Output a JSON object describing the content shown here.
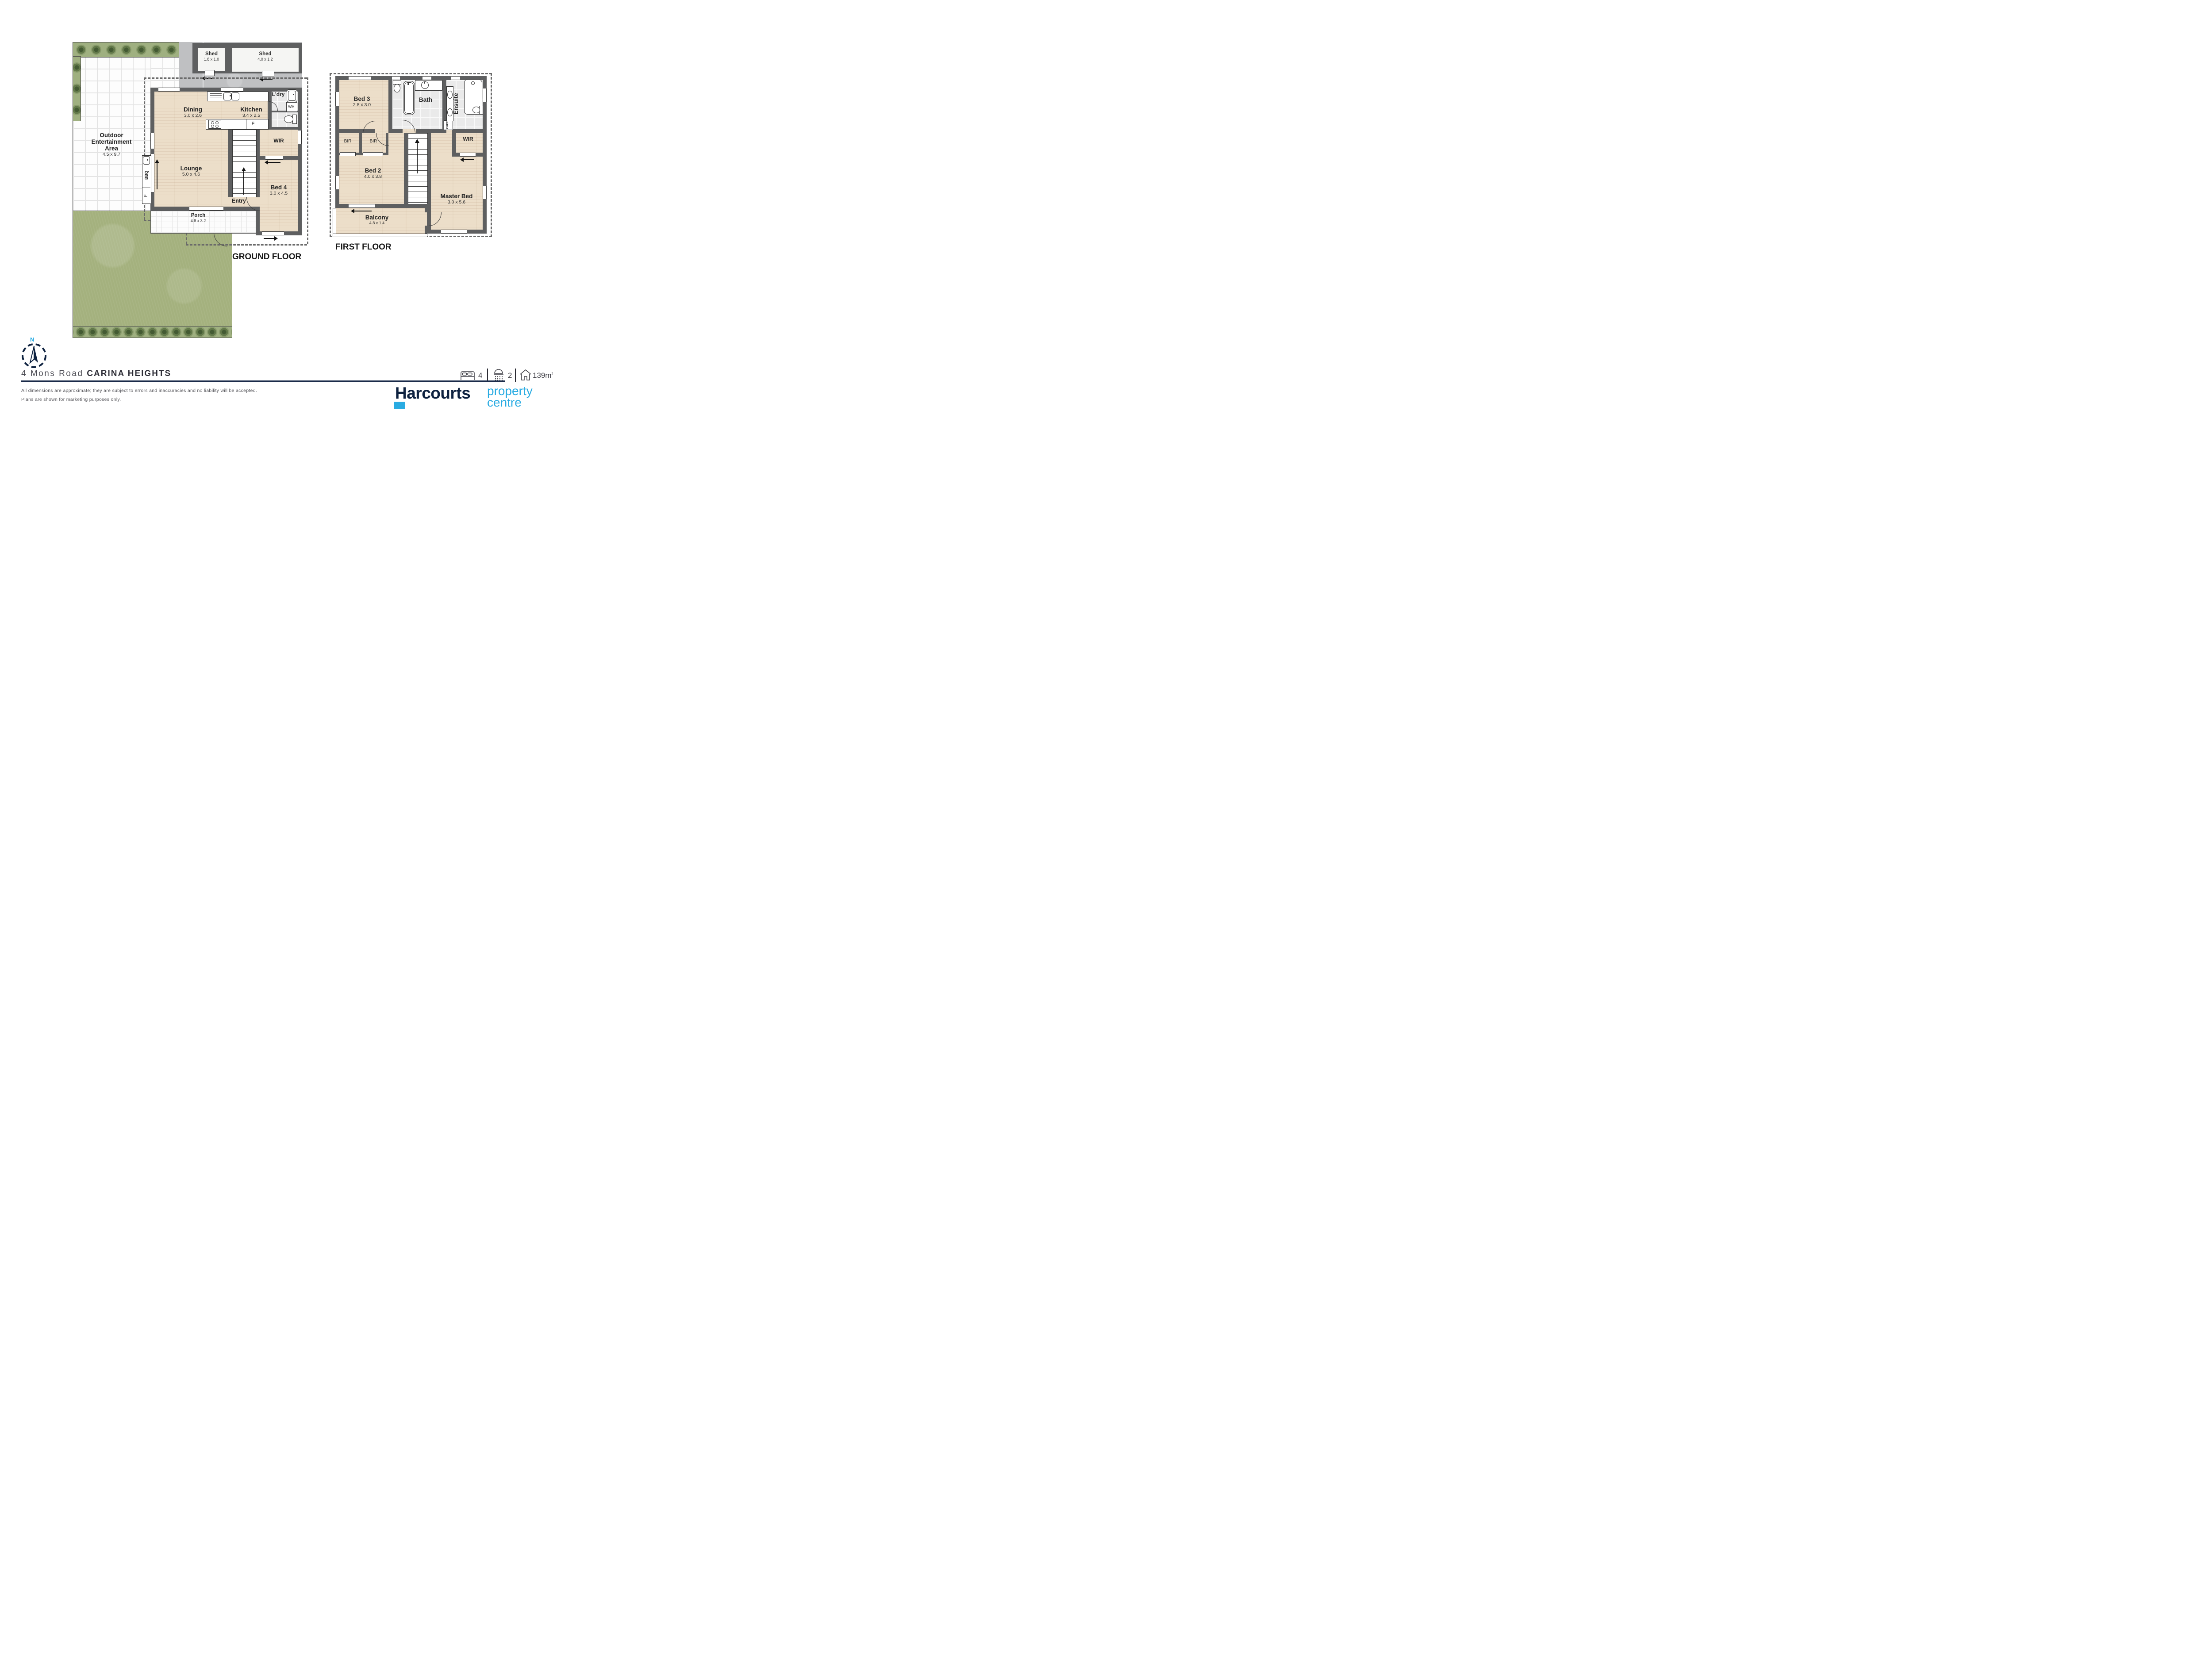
{
  "ground": {
    "title": "GROUND FLOOR",
    "outdoor": {
      "name_lines": [
        "Outdoor",
        "Entertainment",
        "Area"
      ],
      "dims": "4.5 x 9.7"
    },
    "shed_small": {
      "name": "Shed",
      "dims": "1.8 x 1.0"
    },
    "shed_large": {
      "name": "Shed",
      "dims": "4.0 x 1.2"
    },
    "dining": {
      "name": "Dining",
      "dims": "3.0 x 2.6"
    },
    "kitchen": {
      "name": "Kitchen",
      "dims": "3.4 x 2.5"
    },
    "laundry": {
      "name": "L'dry"
    },
    "washing_machine": {
      "name": "WM"
    },
    "wir": {
      "name": "WIR"
    },
    "lounge": {
      "name": "Lounge",
      "dims": "5.0 x 4.6"
    },
    "entry": {
      "name": "Entry"
    },
    "bed4": {
      "name": "Bed 4",
      "dims": "3.0 x 4.5"
    },
    "porch": {
      "name": "Porch",
      "dims": "4.8 x 3.2"
    },
    "bbq": {
      "name": "BBQ"
    },
    "bench_f": {
      "name": "F"
    },
    "kitchen_f": {
      "name": "F"
    }
  },
  "first": {
    "title": "FIRST FLOOR",
    "bed3": {
      "name": "Bed 3",
      "dims": "2.8 x 3.0"
    },
    "bath": {
      "name": "Bath"
    },
    "ensuite": {
      "name": "Ensuite"
    },
    "cupboard": {
      "name": "CUP'D"
    },
    "wir": {
      "name": "WIR"
    },
    "bir_left": {
      "name": "BIR"
    },
    "bir_right": {
      "name": "BIR"
    },
    "bed2": {
      "name": "Bed 2",
      "dims": "4.0 x 3.8"
    },
    "master": {
      "name": "Master Bed",
      "dims": "3.0 x 5.6"
    },
    "balcony": {
      "name": "Balcony",
      "dims": "4.8 x 1.4"
    }
  },
  "compass": {
    "north_label": "N"
  },
  "footer": {
    "address_street": "4 Mons Road",
    "address_suburb": "CARINA HEIGHTS",
    "stats": {
      "beds": "4",
      "showers": "2",
      "area": "139m",
      "area_sup": "2"
    },
    "disclaimer_line1": "All dimensions are approximate; they are subject to errors and inaccuracies and no liability will be accepted.",
    "disclaimer_line2": "Plans are shown for marketing purposes only.",
    "brand": {
      "name": "Harcourts",
      "sub_line1": "property",
      "sub_line2": "centre"
    }
  },
  "colors": {
    "navy": "#0e2240",
    "cyan": "#29abe2",
    "wall_grey": "#5e5f60"
  }
}
